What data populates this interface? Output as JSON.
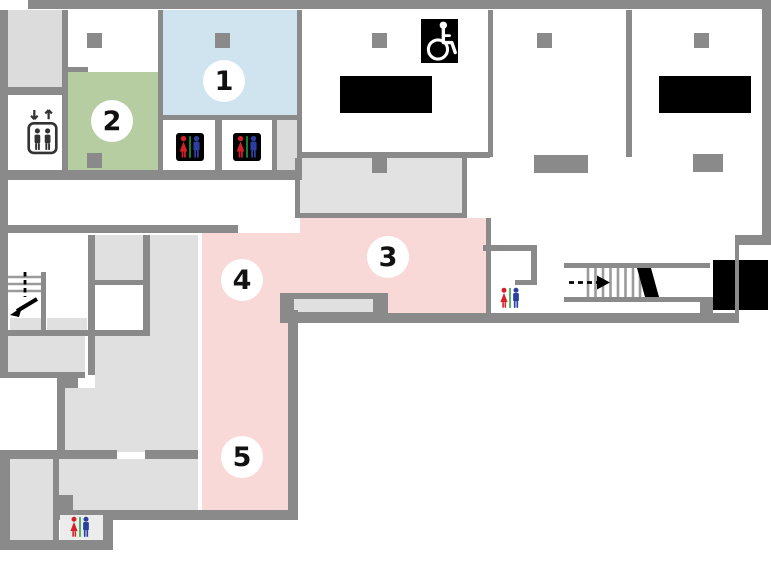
{
  "floor_plan": {
    "title": "building-floor-map",
    "markers": [
      {
        "id": "area-1",
        "label": "1",
        "area_color": "#cfe4ee"
      },
      {
        "id": "area-2",
        "label": "2",
        "area_color": "#b5cda1"
      },
      {
        "id": "area-3",
        "label": "3",
        "area_color": "#f9d8d8"
      },
      {
        "id": "area-4",
        "label": "4",
        "area_color": "#f9d8d8"
      },
      {
        "id": "area-5",
        "label": "5",
        "area_color": "#f9d8d8"
      }
    ],
    "colors": {
      "wall": "#8a8a8a",
      "room_light_gray": "#e0e0e0",
      "foyer_gray": "#e2e2e2",
      "area_blue": "#cfe4ee",
      "area_green": "#b5cda1",
      "area_pink": "#f9d8d8",
      "feature_black": "#000000",
      "restroom_female": "#d42127",
      "restroom_male": "#2b3f9e",
      "restroom_divider": "#1f9d3a"
    },
    "icons": [
      {
        "name": "elevator-icon"
      },
      {
        "name": "wheelchair-accessible-icon"
      },
      {
        "name": "restroom-icon-dark",
        "count": 2
      },
      {
        "name": "restroom-icon-light",
        "count": 2
      },
      {
        "name": "stairs-down-icon-west"
      },
      {
        "name": "stairs-icon-east"
      }
    ]
  }
}
